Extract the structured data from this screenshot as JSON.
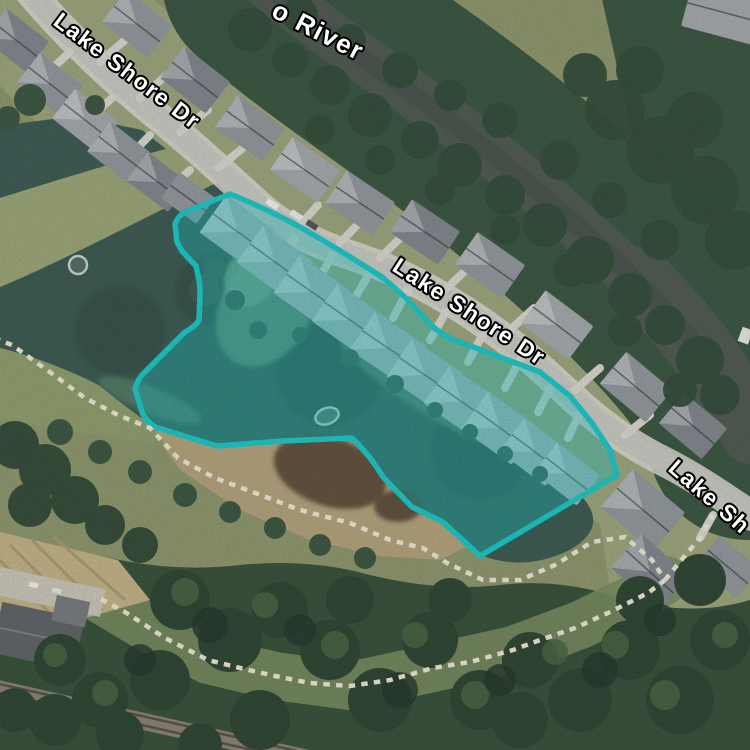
{
  "map": {
    "view": "satellite-imagery",
    "labels": {
      "river_partial": "o River",
      "street_top_left": "Lake Shore Dr",
      "street_middle": "Lake Shore Dr",
      "street_right_partial": "Lake Sh"
    },
    "selection": {
      "type": "polygon-highlight",
      "covers": "lakefront homes and northeast portion of lake along Lake Shore Dr"
    },
    "colors": {
      "selection_stroke": "#12c6c6",
      "selection_fill": "rgba(16,199,197,0.37)",
      "water": "#34544c",
      "river": "#49544b",
      "road": "#c8c9c2",
      "trail": "#efe8d5",
      "forest": "#2f4a33",
      "grass": "#8a9468",
      "field": "#c2b183",
      "roof_gray": "#8f959b"
    }
  }
}
